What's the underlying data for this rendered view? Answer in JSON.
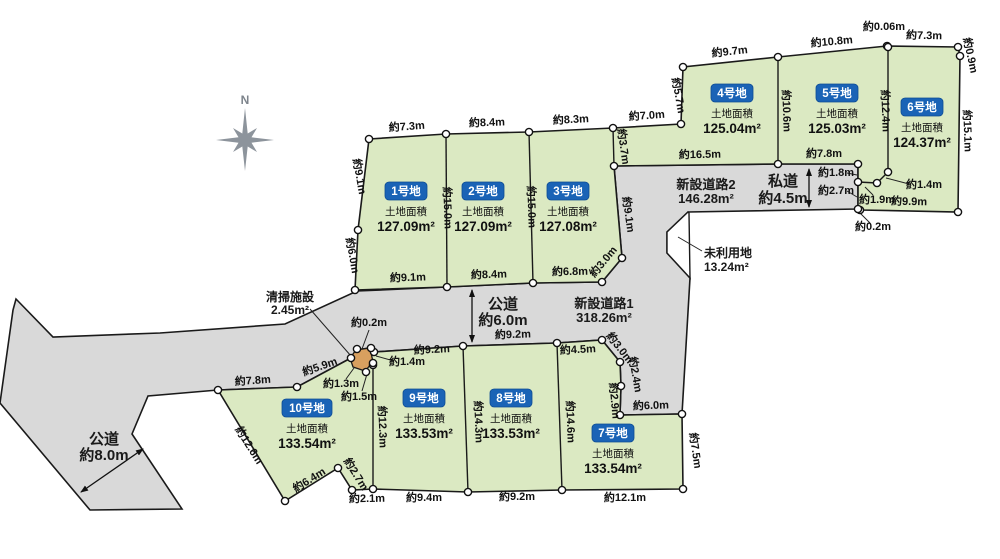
{
  "compass": {
    "label": "N"
  },
  "colors": {
    "plot_green": "#dbe9c2",
    "road_gray": "#d9d9d9",
    "badge_blue": "#1a63b6",
    "facility_tan": "#d8a05f",
    "compass_gray": "#8d949c"
  },
  "plots": [
    {
      "badge": "1号地",
      "area_label": "土地面積",
      "area_value": "127.09m²",
      "x": 406,
      "y": 191,
      "w": 42
    },
    {
      "badge": "2号地",
      "area_label": "土地面積",
      "area_value": "127.09m²",
      "x": 483,
      "y": 191,
      "w": 42
    },
    {
      "badge": "3号地",
      "area_label": "土地面積",
      "area_value": "127.08m²",
      "x": 568,
      "y": 191,
      "w": 42
    },
    {
      "badge": "4号地",
      "area_label": "土地面積",
      "area_value": "125.04m²",
      "x": 732,
      "y": 93,
      "w": 42
    },
    {
      "badge": "5号地",
      "area_label": "土地面積",
      "area_value": "125.03m²",
      "x": 837,
      "y": 93,
      "w": 42
    },
    {
      "badge": "6号地",
      "area_label": "土地面積",
      "area_value": "124.37m²",
      "x": 922,
      "y": 107,
      "w": 42
    },
    {
      "badge": "7号地",
      "area_label": "土地面積",
      "area_value": "133.54m²",
      "x": 613,
      "y": 433,
      "w": 42
    },
    {
      "badge": "8号地",
      "area_label": "土地面積",
      "area_value": "133.53m²",
      "x": 511,
      "y": 398,
      "w": 42
    },
    {
      "badge": "9号地",
      "area_label": "土地面積",
      "area_value": "133.53m²",
      "x": 424,
      "y": 398,
      "w": 42
    },
    {
      "badge": "10号地",
      "area_label": "土地面積",
      "area_value": "133.54m²",
      "x": 307,
      "y": 408,
      "w": 50
    }
  ],
  "road_labels": [
    {
      "name": "public-road-8m",
      "lines": [
        "公道",
        "約8.0m"
      ],
      "x": 104,
      "y": 444,
      "fs": 15,
      "lh": 16,
      "anchor": "middle"
    },
    {
      "name": "public-road-6m",
      "lines": [
        "公道",
        "約6.0m"
      ],
      "x": 503,
      "y": 309,
      "fs": 15,
      "lh": 16,
      "anchor": "middle"
    },
    {
      "name": "new-road-1",
      "lines": [
        "新設道路1",
        "318.26m²"
      ],
      "x": 604,
      "y": 308,
      "fs": 13,
      "lh": 14,
      "anchor": "middle"
    },
    {
      "name": "new-road-2",
      "lines": [
        "新設道路2",
        "146.28m²"
      ],
      "x": 706,
      "y": 189,
      "fs": 13,
      "lh": 14,
      "anchor": "middle"
    },
    {
      "name": "private-road",
      "lines": [
        "私道",
        "約4.5m"
      ],
      "x": 783,
      "y": 186,
      "fs": 15,
      "lh": 17,
      "anchor": "middle"
    },
    {
      "name": "unused-land",
      "lines": [
        "未利用地",
        "13.24m²"
      ],
      "x": 704,
      "y": 257,
      "fs": 12,
      "lh": 14,
      "anchor": "start"
    },
    {
      "name": "cleaning-facility",
      "lines": [
        "清掃施設",
        "2.45m²"
      ],
      "x": 290,
      "y": 301,
      "fs": 12,
      "lh": 13,
      "anchor": "middle"
    }
  ],
  "dimensions": [
    {
      "t": "約7.3m",
      "x": 407,
      "y": 130,
      "r": -4
    },
    {
      "t": "約8.4m",
      "x": 487,
      "y": 126,
      "r": -2
    },
    {
      "t": "約8.3m",
      "x": 571,
      "y": 123,
      "r": -3
    },
    {
      "t": "約7.0m",
      "x": 647,
      "y": 119,
      "r": -4
    },
    {
      "t": "約9.7m",
      "x": 730,
      "y": 55,
      "r": -6
    },
    {
      "t": "約10.8m",
      "x": 832,
      "y": 45,
      "r": -5
    },
    {
      "t": "約0.06m",
      "x": 884,
      "y": 30,
      "r": 0
    },
    {
      "t": "約7.3m",
      "x": 924,
      "y": 39,
      "r": 1
    },
    {
      "t": "約0.9m",
      "x": 967,
      "y": 56,
      "r": 78
    },
    {
      "t": "約5.7m",
      "x": 675,
      "y": 96,
      "r": 80
    },
    {
      "t": "約10.6m",
      "x": 783,
      "y": 111,
      "r": 88
    },
    {
      "t": "約12.4m",
      "x": 882,
      "y": 111,
      "r": 88
    },
    {
      "t": "約15.1m",
      "x": 964,
      "y": 131,
      "r": 88
    },
    {
      "t": "約3.7m",
      "x": 620,
      "y": 147,
      "r": 82
    },
    {
      "t": "約9.1m",
      "x": 356,
      "y": 177,
      "r": 80
    },
    {
      "t": "約15.0m",
      "x": 444,
      "y": 208,
      "r": 88
    },
    {
      "t": "約15.0m",
      "x": 528,
      "y": 207,
      "r": 88
    },
    {
      "t": "約9.1m",
      "x": 625,
      "y": 215,
      "r": 82
    },
    {
      "t": "約6.0m",
      "x": 349,
      "y": 256,
      "r": 80
    },
    {
      "t": "約16.5m",
      "x": 700,
      "y": 158,
      "r": -1
    },
    {
      "t": "約7.8m",
      "x": 824,
      "y": 157,
      "r": 0
    },
    {
      "t": "約1.8m",
      "x": 836,
      "y": 176,
      "r": 0
    },
    {
      "t": "約2.7m",
      "x": 836,
      "y": 194,
      "r": 0
    },
    {
      "t": "約1.9m",
      "x": 877,
      "y": 203,
      "r": 0
    },
    {
      "t": "約1.4m",
      "x": 924,
      "y": 188,
      "r": 0
    },
    {
      "t": "約9.9m",
      "x": 909,
      "y": 205,
      "r": 1
    },
    {
      "t": "約0.2m",
      "x": 873,
      "y": 230,
      "r": 0
    },
    {
      "t": "約9.1m",
      "x": 408,
      "y": 281,
      "r": -2
    },
    {
      "t": "約8.4m",
      "x": 489,
      "y": 278,
      "r": -2
    },
    {
      "t": "約6.8m",
      "x": 570,
      "y": 275,
      "r": -1
    },
    {
      "t": "約3.0m",
      "x": 606,
      "y": 264,
      "r": -50
    },
    {
      "t": "約0.2m",
      "x": 369,
      "y": 326,
      "r": 0
    },
    {
      "t": "約9.2m",
      "x": 432,
      "y": 353,
      "r": -3
    },
    {
      "t": "約9.2m",
      "x": 513,
      "y": 338,
      "r": -2
    },
    {
      "t": "約4.5m",
      "x": 578,
      "y": 353,
      "r": -3
    },
    {
      "t": "約3.0m",
      "x": 617,
      "y": 350,
      "r": 52
    },
    {
      "t": "約2.4m",
      "x": 632,
      "y": 375,
      "r": 80
    },
    {
      "t": "約2.9m",
      "x": 611,
      "y": 401,
      "r": 85
    },
    {
      "t": "約6.0m",
      "x": 651,
      "y": 409,
      "r": -2
    },
    {
      "t": "約1.4m",
      "x": 407,
      "y": 365,
      "r": 0
    },
    {
      "t": "約1.3m",
      "x": 341,
      "y": 387,
      "r": 0
    },
    {
      "t": "約1.5m",
      "x": 359,
      "y": 400,
      "r": 0
    },
    {
      "t": "約5.9m",
      "x": 321,
      "y": 370,
      "r": -19
    },
    {
      "t": "約7.8m",
      "x": 253,
      "y": 384,
      "r": -4
    },
    {
      "t": "約12.3m",
      "x": 379,
      "y": 427,
      "r": 88
    },
    {
      "t": "約14.3m",
      "x": 475,
      "y": 422,
      "r": 88
    },
    {
      "t": "約14.6m",
      "x": 567,
      "y": 422,
      "r": 88
    },
    {
      "t": "約12.6m",
      "x": 246,
      "y": 447,
      "r": 58
    },
    {
      "t": "約6.4m",
      "x": 311,
      "y": 483,
      "r": -32
    },
    {
      "t": "約2.7m",
      "x": 353,
      "y": 476,
      "r": 58
    },
    {
      "t": "約2.1m",
      "x": 367,
      "y": 502,
      "r": -1
    },
    {
      "t": "約9.4m",
      "x": 424,
      "y": 501,
      "r": 0
    },
    {
      "t": "約9.2m",
      "x": 517,
      "y": 500,
      "r": 0
    },
    {
      "t": "約12.1m",
      "x": 625,
      "y": 501,
      "r": 0
    },
    {
      "t": "約7.5m",
      "x": 692,
      "y": 451,
      "r": 82
    }
  ]
}
